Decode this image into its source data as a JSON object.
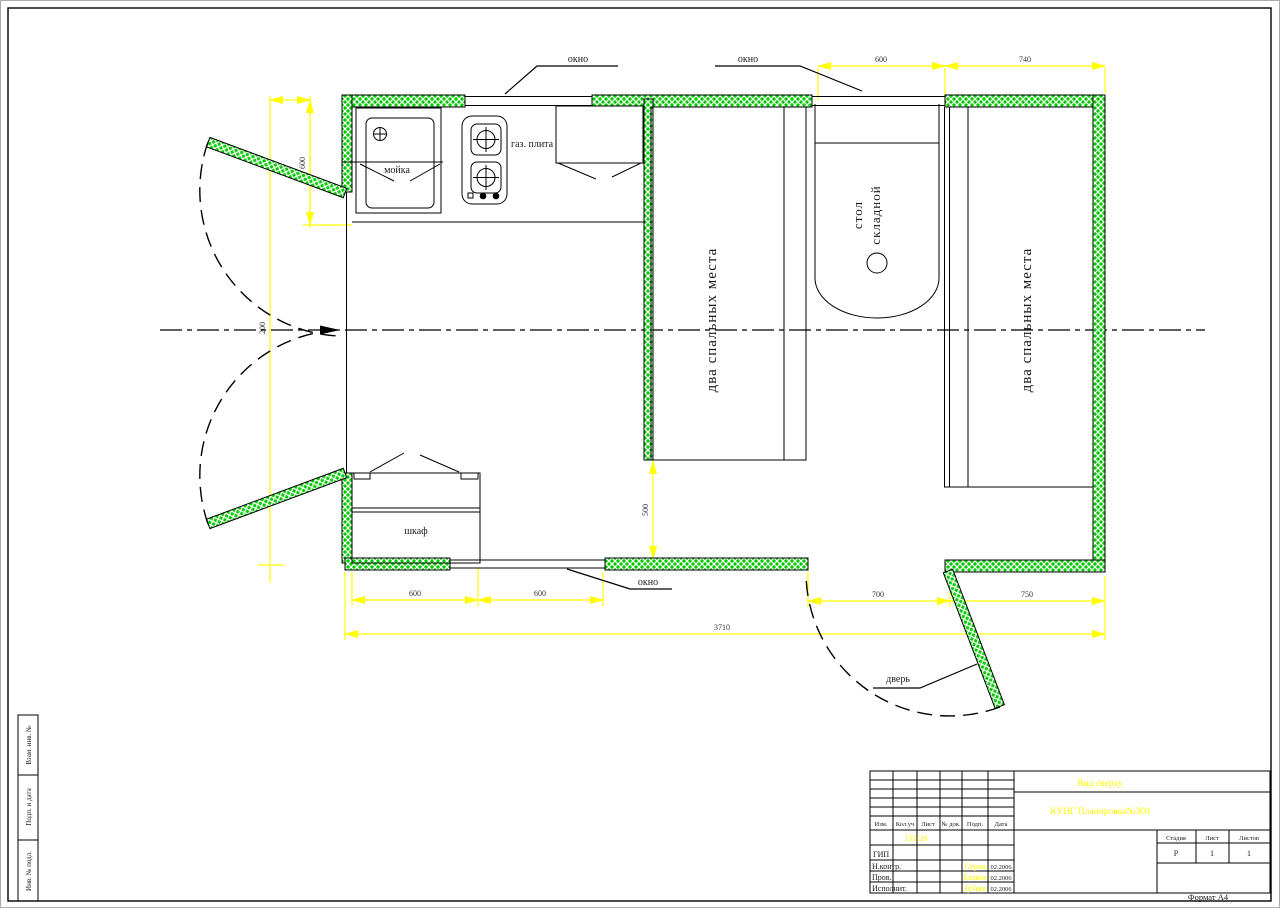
{
  "colors": {
    "wall_green": "#00cc00",
    "dim_yellow": "#ffff00"
  },
  "labels": {
    "window": "окно",
    "door": "дверь",
    "sink": "мойка",
    "stove": "газ. плита",
    "table_line1": "стол",
    "table_line2": "складной",
    "beds": "два спальных места",
    "closet": "шкаф"
  },
  "dims": {
    "d600": "600",
    "d740": "740",
    "d500": "500",
    "d200": "200",
    "d700": "700",
    "d750": "750",
    "d3710": "3710"
  },
  "title_block": {
    "view_title": "Вид сверху",
    "doc_title": "КУНГ Планировка№300",
    "doc_number": "133-26",
    "headers": {
      "izm": "Изм.",
      "kol": "Кол.уч",
      "list": "Лист",
      "ndok": "№ док.",
      "podp": "Подп.",
      "data": "Дата"
    },
    "rows": {
      "gip": "ГИП",
      "nkontr": "Н.контр.",
      "prov": "Пров.",
      "ispolnit": "Исполнит."
    },
    "names": {
      "nkontr": "Серов",
      "prov": "Бляков",
      "ispolnit": "Зубков"
    },
    "dates": {
      "nkontr": "02.2006",
      "prov": "02.2006",
      "ispolnit": "02.2006"
    },
    "stage": {
      "stadiya_label": "Стадия",
      "list_label": "Лист",
      "listov_label": "Листов",
      "stadiya": "Р",
      "list": "1",
      "listov": "1"
    },
    "format": "Формат А4"
  },
  "stamp_strip": {
    "cells": [
      {
        "label": "Взам. инв. №"
      },
      {
        "label": "Подп. и дата"
      },
      {
        "label": "Инв. № подл."
      }
    ]
  }
}
